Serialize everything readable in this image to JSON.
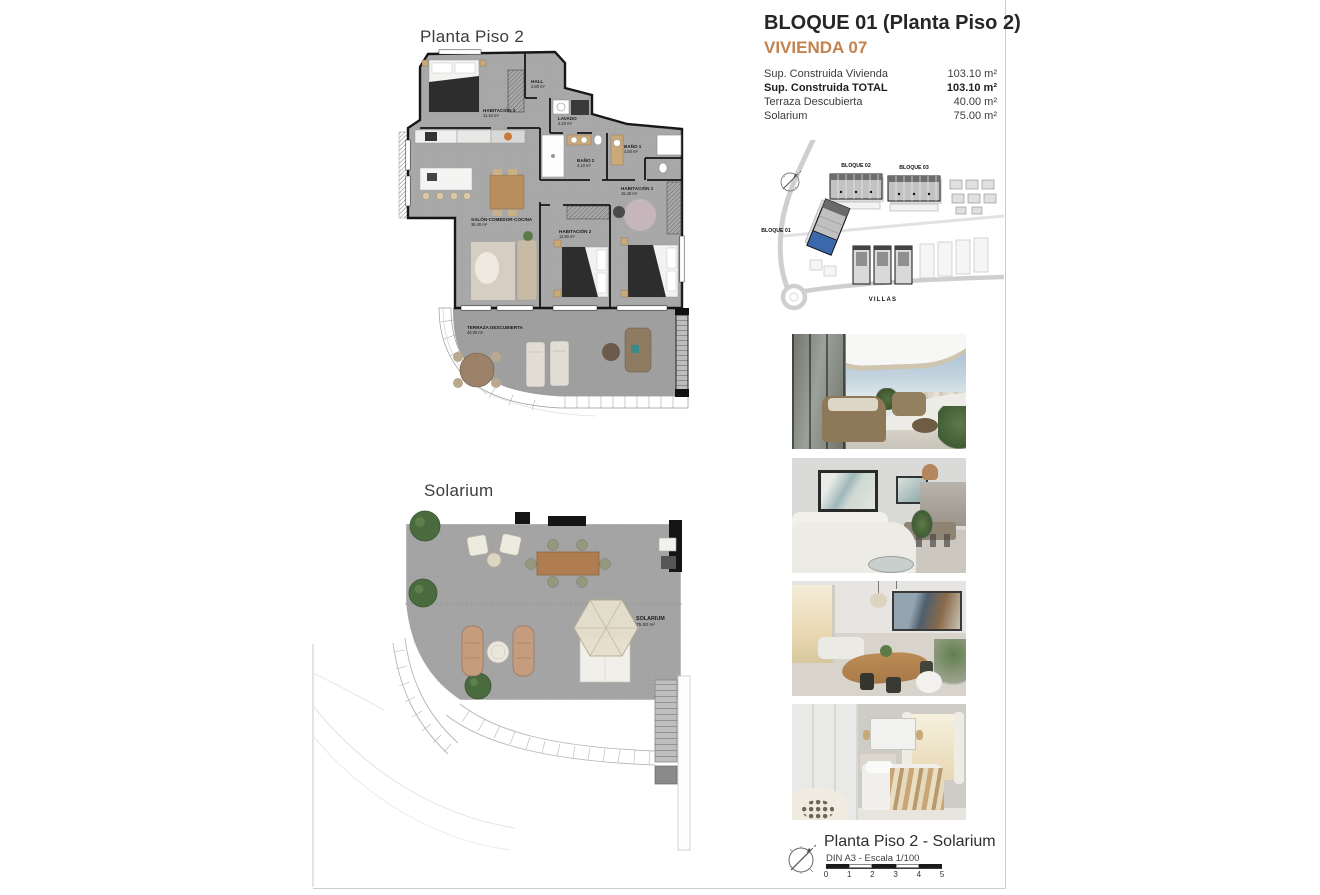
{
  "header": {
    "block_title": "BLOQUE 01  (Planta Piso 2)",
    "unit_title": "VIVIENDA 07"
  },
  "summary": {
    "rows": [
      {
        "label": "Sup. Construida Vivienda",
        "value": "103.10 m²"
      },
      {
        "label": "Sup. Construida TOTAL",
        "value": "103.10 m²"
      },
      {
        "label": "Terraza Descubierta",
        "value": "40.00 m²"
      },
      {
        "label": "Solarium",
        "value": "75.00 m²"
      }
    ]
  },
  "site": {
    "bloque01": "BLOQUE 01",
    "bloque02": "BLOQUE 02",
    "bloque03": "BLOQUE 03",
    "villas": "VILLAS"
  },
  "plan1": {
    "title": "Planta Piso 2",
    "rooms": [
      {
        "name": "HABITACIÓN 3",
        "area": "11.10 m²"
      },
      {
        "name": "HALL",
        "area": "2.80 m²"
      },
      {
        "name": "LAVADO",
        "area": "2.20 m²"
      },
      {
        "name": "BAÑO 2",
        "area": "4.10 m²"
      },
      {
        "name": "BAÑO 1",
        "area": "4.50 m²"
      },
      {
        "name": "HABITACIÓN 1",
        "area": "15.40 m²"
      },
      {
        "name": "HABITACIÓN 2",
        "area": "11.90 m²"
      },
      {
        "name": "SALÓN-COMEDOR-COCINA",
        "area": "36.40 m²"
      },
      {
        "name": "TERRAZA DESCUBIERTA",
        "area": "40.00 m²"
      }
    ]
  },
  "plan2": {
    "title": "Solarium",
    "rooms": [
      {
        "name": "SOLARIUM",
        "area": "75.00 m²"
      }
    ]
  },
  "footer": {
    "title": "Planta Piso 2 - Solarium",
    "scale_note": "DIN A3 - Escala 1/100",
    "scale_ticks": [
      "0",
      "1",
      "2",
      "3",
      "4",
      "5"
    ]
  },
  "colors": {
    "accent_orange": "#c4824e",
    "highlight_blue": "#3b68ac",
    "plan_floor_gray": "#a6a6a6",
    "wall_black": "#161616"
  }
}
